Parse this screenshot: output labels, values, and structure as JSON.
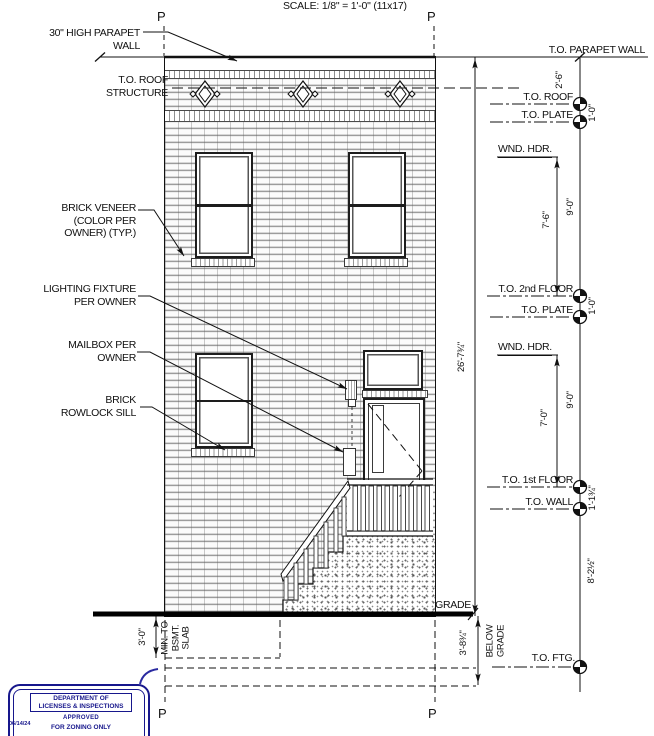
{
  "sheet": {
    "scale_note": "SCALE: 1/8\" = 1'-0\" (11x17)",
    "property_line_marker": "P"
  },
  "left_annotations": {
    "parapet": [
      "30\" HIGH PARAPET",
      "WALL"
    ],
    "roof_structure": [
      "T.O. ROOF",
      "STRUCTURE"
    ],
    "brick_veneer": [
      "BRICK VENEER",
      "(COLOR PER",
      "OWNER) (TYP.)"
    ],
    "lighting": [
      "LIGHTING FIXTURE",
      "PER OWNER"
    ],
    "mailbox": [
      "MAILBOX PER",
      "OWNER"
    ],
    "rowlock": [
      "BRICK",
      "ROWLOCK SILL"
    ]
  },
  "right_annotations": {
    "parapet_wall": "T.O. PARAPET WALL",
    "roof": "T.O. ROOF",
    "plate_upper": "T.O. PLATE",
    "wnd_hdr_upper": "WND. HDR.",
    "second_floor": "T.O. 2nd FLOOR",
    "plate_lower": "T.O. PLATE",
    "wnd_hdr_lower": "WND. HDR.",
    "first_floor": "T.O. 1st FLOOR",
    "wall": "T.O. WALL",
    "grade": "GRADE",
    "footing": "T.O. FTG."
  },
  "dimensions": {
    "parapet_height": "2'-6\"",
    "roof_to_plate": "1'-0\"",
    "plate_to_2nd_floor": "9'-0\"",
    "wnd_hdr_to_2nd_floor": "7'-6\"",
    "second_floor_to_plate": "1'-0\"",
    "plate_to_1st_floor": "9'-0\"",
    "wnd_hdr_to_1st_floor": "7'-0\"",
    "first_floor_to_wall": "1'-1¾\"",
    "wall_to_footing": "8'-2½\"",
    "overall_height": "26'-7¾\"",
    "grade_to_footing": "3'-8¾\"",
    "below_grade": [
      "BELOW",
      "GRADE"
    ],
    "bsmt_depth": "3'-0\"",
    "bsmt_note": [
      "MIN. TO",
      "BSMT.",
      "SLAB"
    ]
  },
  "stamp": {
    "dept_line1": "DEPARTMENT OF",
    "dept_line2": "LICENSES & INSPECTIONS",
    "approved": "APPROVED",
    "zoning": "FOR ZONING ONLY",
    "date": "06/14/24",
    "ink_color": "#17178c"
  },
  "colors": {
    "line_ink": "#111111",
    "stamp_navy": "#17178c",
    "brick_mortar": "#9c9c9c"
  }
}
